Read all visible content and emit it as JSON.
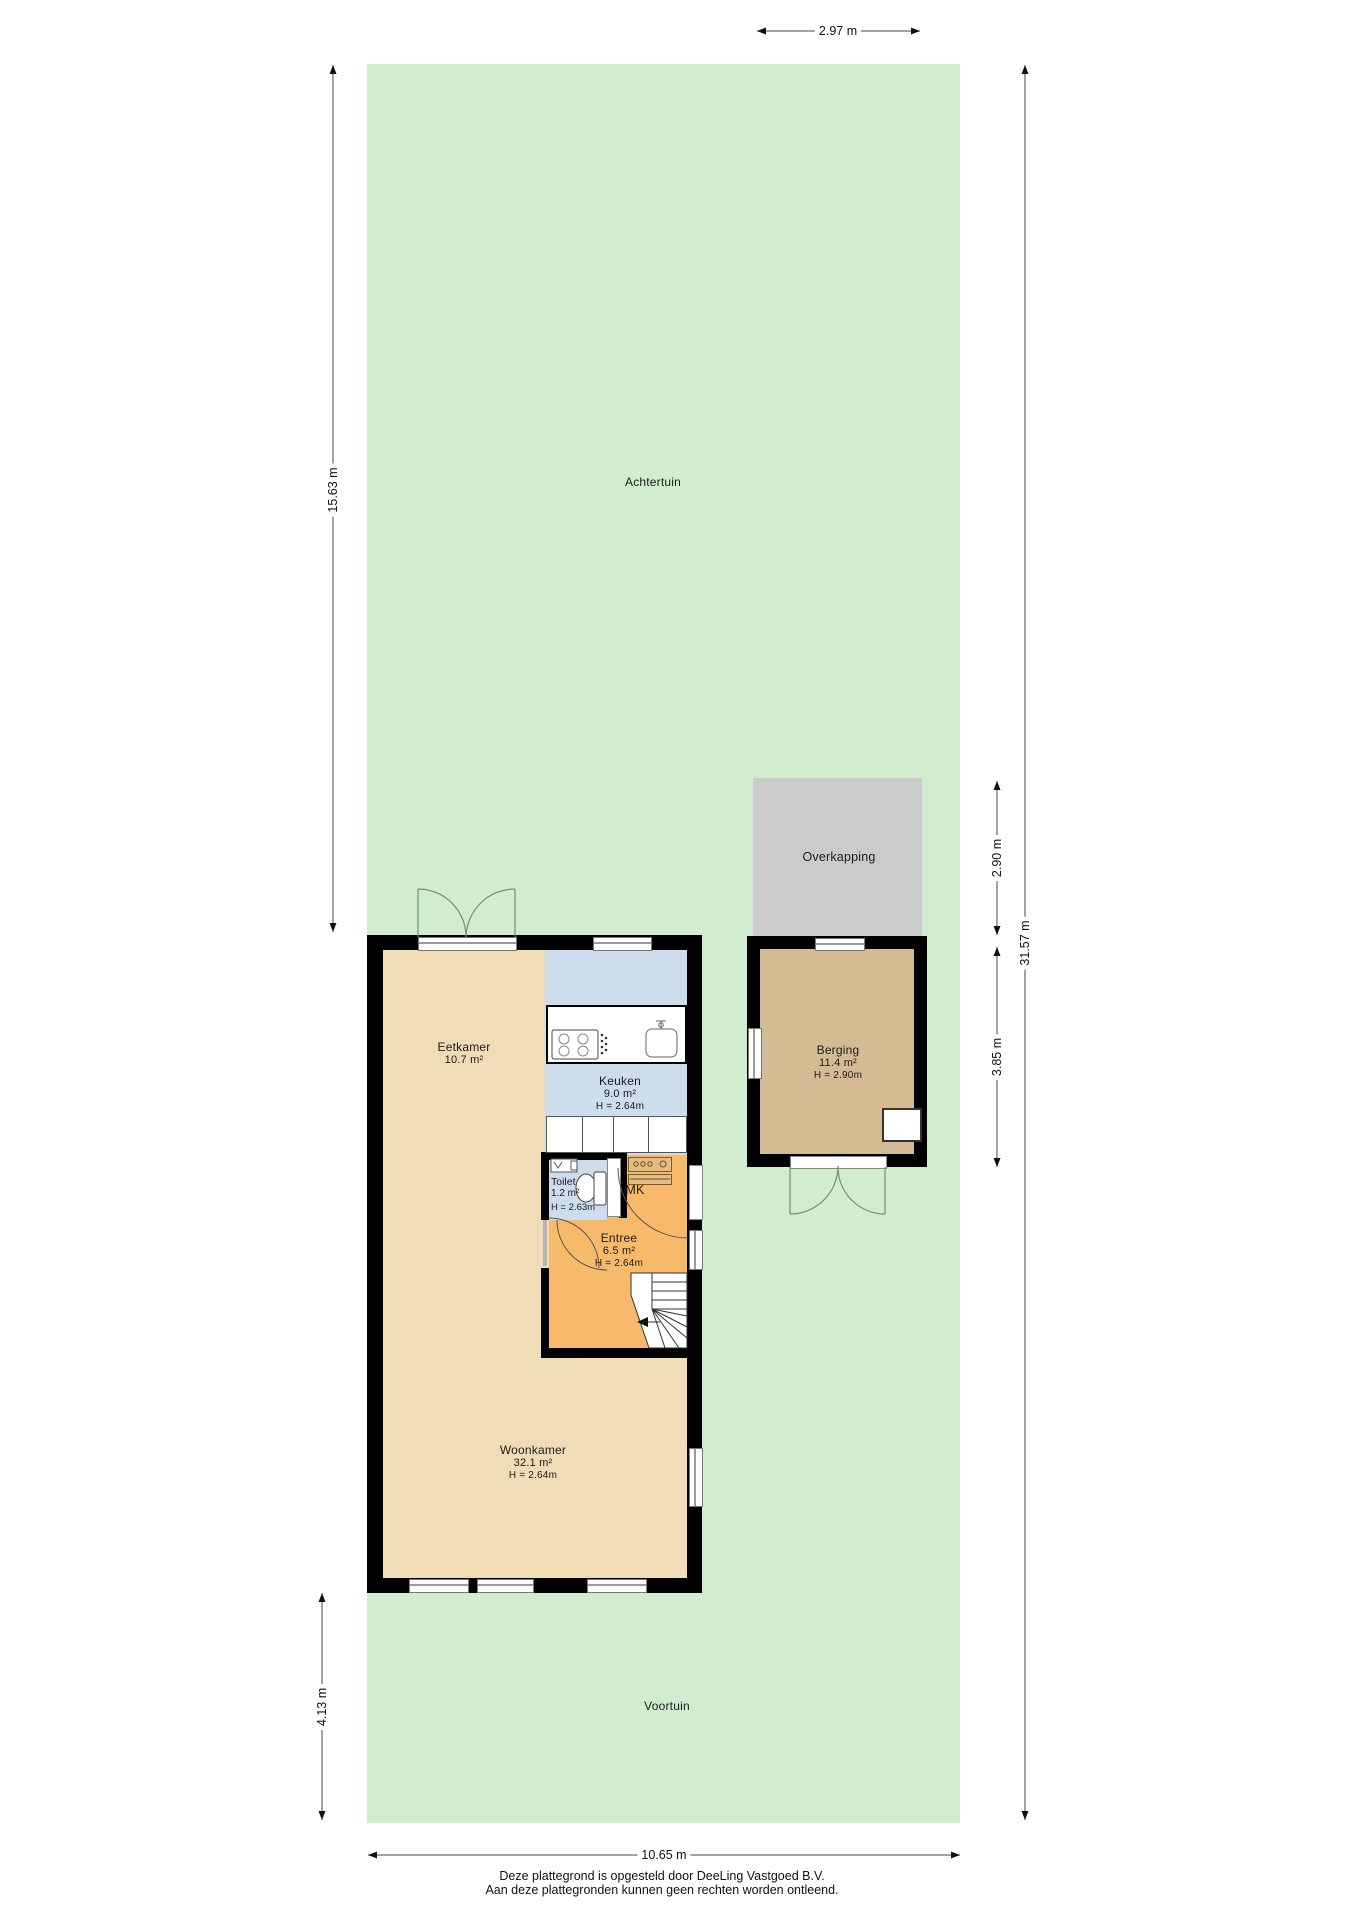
{
  "garden": {
    "back_label": "Achtertuin",
    "front_label": "Voortuin"
  },
  "structures": {
    "overkapping_label": "Overkapping",
    "mk_label": "MK"
  },
  "rooms": {
    "eetkamer": {
      "name": "Eetkamer",
      "area": "10.7 m²"
    },
    "keuken": {
      "name": "Keuken",
      "area": "9.0 m²",
      "height": "H = 2.64m"
    },
    "toilet": {
      "name": "Toilet",
      "area": "1.2 m²",
      "height": "H = 2.63m"
    },
    "entree": {
      "name": "Entree",
      "area": "6.5 m²",
      "height": "H = 2.64m"
    },
    "woonkamer": {
      "name": "Woonkamer",
      "area": "32.1 m²",
      "height": "H = 2.64m"
    },
    "berging": {
      "name": "Berging",
      "area": "11.4 m²",
      "height": "H = 2.90m"
    }
  },
  "dimensions": {
    "overkapping_width": "2.97 m",
    "achtertuin_depth": "15.63 m",
    "overkapping_depth": "2.90 m",
    "berging_depth": "3.85 m",
    "total_depth": "31.57 m",
    "voortuin_depth": "4.13 m",
    "plot_width": "10.65 m"
  },
  "footer": {
    "line1": "Deze plattegrond is opgesteld door DeeLing Vastgoed B.V.",
    "line2": "Aan deze plattegronden kunnen geen rechten worden ontleend."
  },
  "colors": {
    "garden": "#d2ecd0",
    "living_floor": "#f0dcb6",
    "kitchen_floor": "#cddded",
    "hall_floor": "#f7ba6b",
    "berging_floor": "#d5bb94",
    "overkapping": "#cbcbcb",
    "walls": "#000000"
  }
}
